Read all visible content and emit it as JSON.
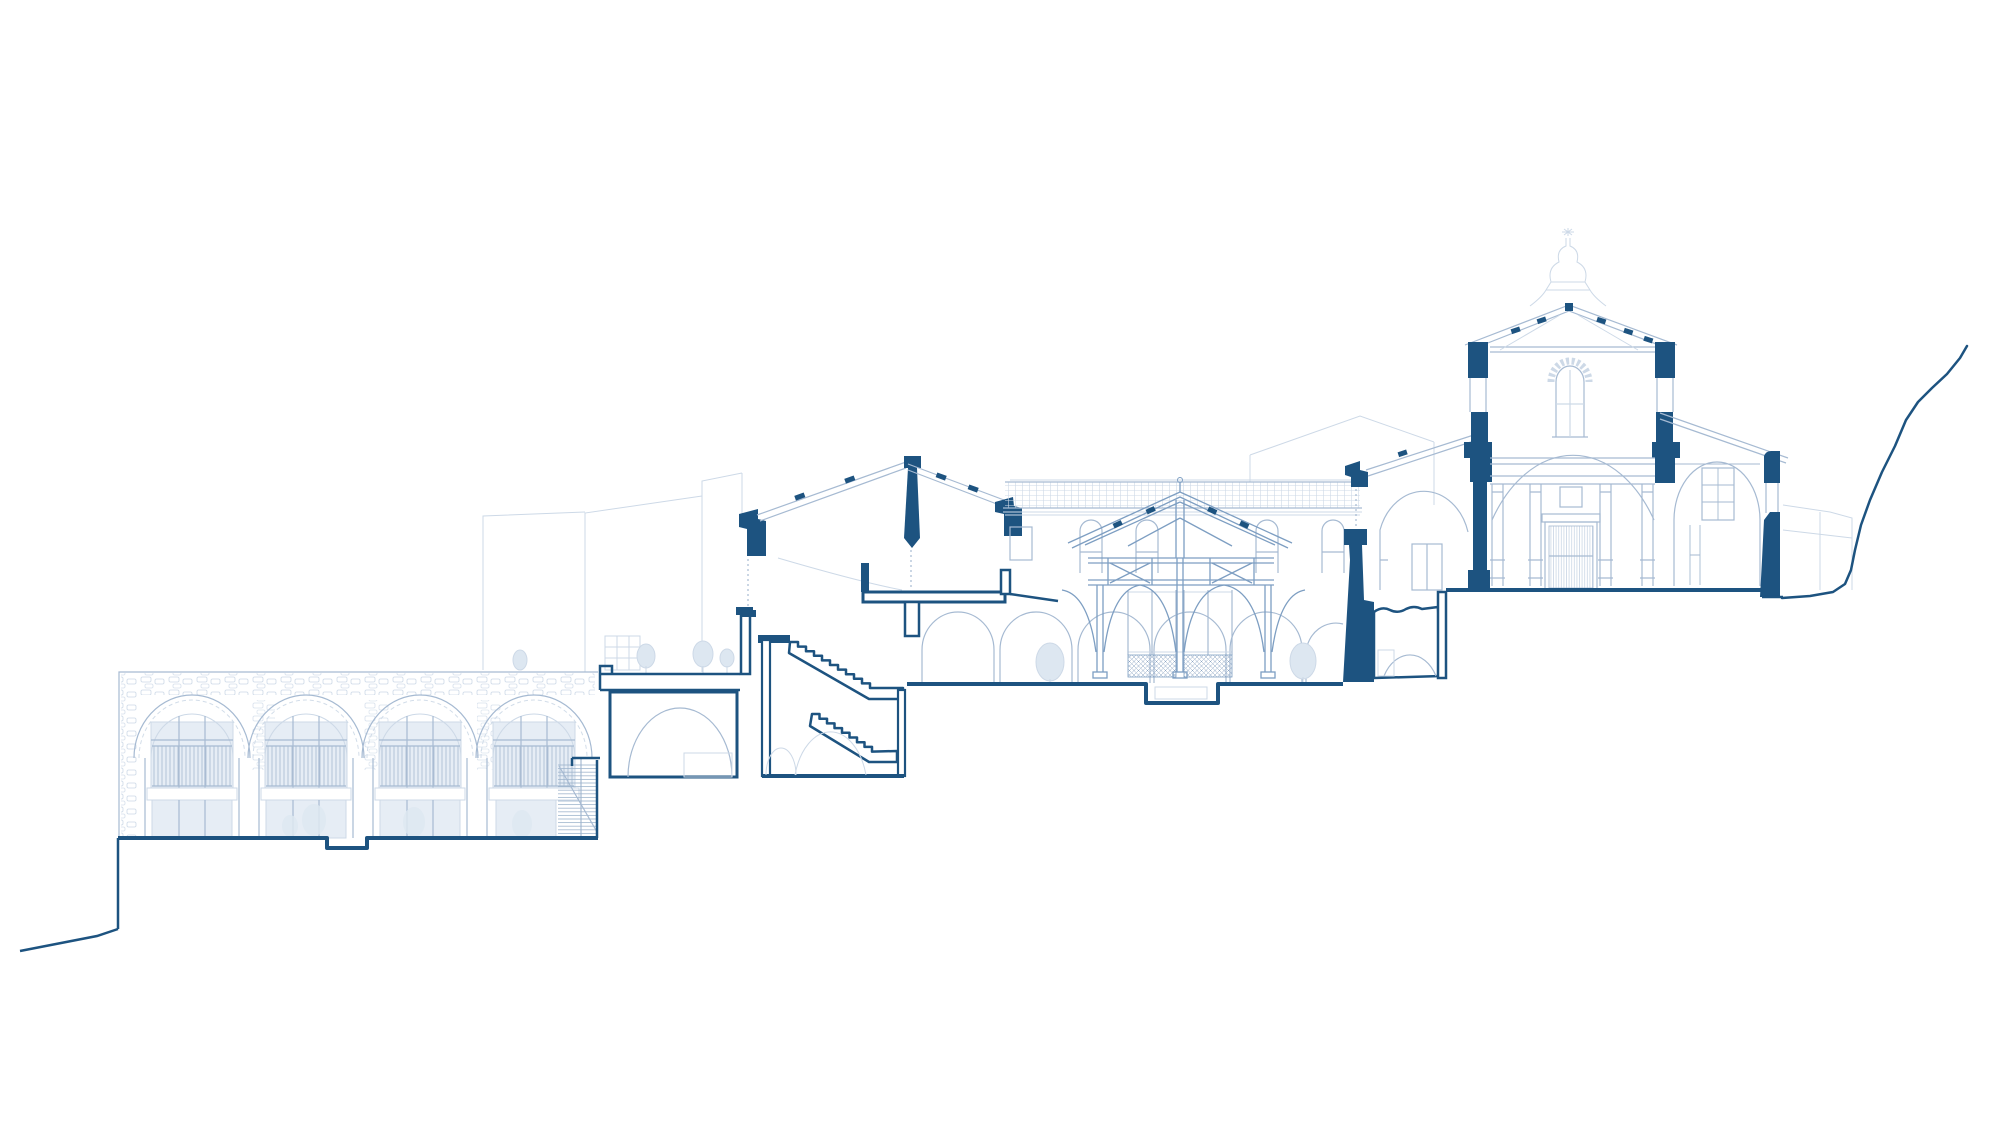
{
  "drawing": {
    "type": "architectural-longitudinal-section",
    "subject": "hillside monastery complex section-elevation",
    "visible_text": [],
    "parts": [
      {
        "name": "terrain-left",
        "kind": "cut-ground-line"
      },
      {
        "name": "stone-arcade-building",
        "kind": "background-elevation",
        "arches": 4
      },
      {
        "name": "small-side-stair",
        "kind": "stair-elevation"
      },
      {
        "name": "terrace-with-planters",
        "kind": "cut-slab"
      },
      {
        "name": "vaulted-cellar-room",
        "kind": "cut-room"
      },
      {
        "name": "grand-staircase-block",
        "kind": "cut-section",
        "flights": 2
      },
      {
        "name": "cloister-wing",
        "kind": "background-elevation",
        "roof": "tiled"
      },
      {
        "name": "timber-truss-pavilion",
        "kind": "section-detail",
        "posts": 3
      },
      {
        "name": "sunken-pit",
        "kind": "cut-ground"
      },
      {
        "name": "retaining-wall",
        "kind": "cut-wall"
      },
      {
        "name": "undercroft-room",
        "kind": "cut-room"
      },
      {
        "name": "church-nave",
        "kind": "cut-section",
        "features": [
          "dome",
          "lantern-with-cross",
          "gable-roof",
          "portal-door",
          "pilasters"
        ]
      },
      {
        "name": "side-chapel",
        "kind": "background-elevation"
      },
      {
        "name": "terrain-right",
        "kind": "cut-ground-line"
      }
    ]
  },
  "palette": {
    "dark": "#1d5380",
    "md": "#7d9ec2",
    "lt": "#a6bad2",
    "xl": "#cdd9e7",
    "glass": "#e6edf5",
    "panel": "#edf2f8",
    "paper": "#ffffff",
    "foliage": "#dde7f1"
  }
}
